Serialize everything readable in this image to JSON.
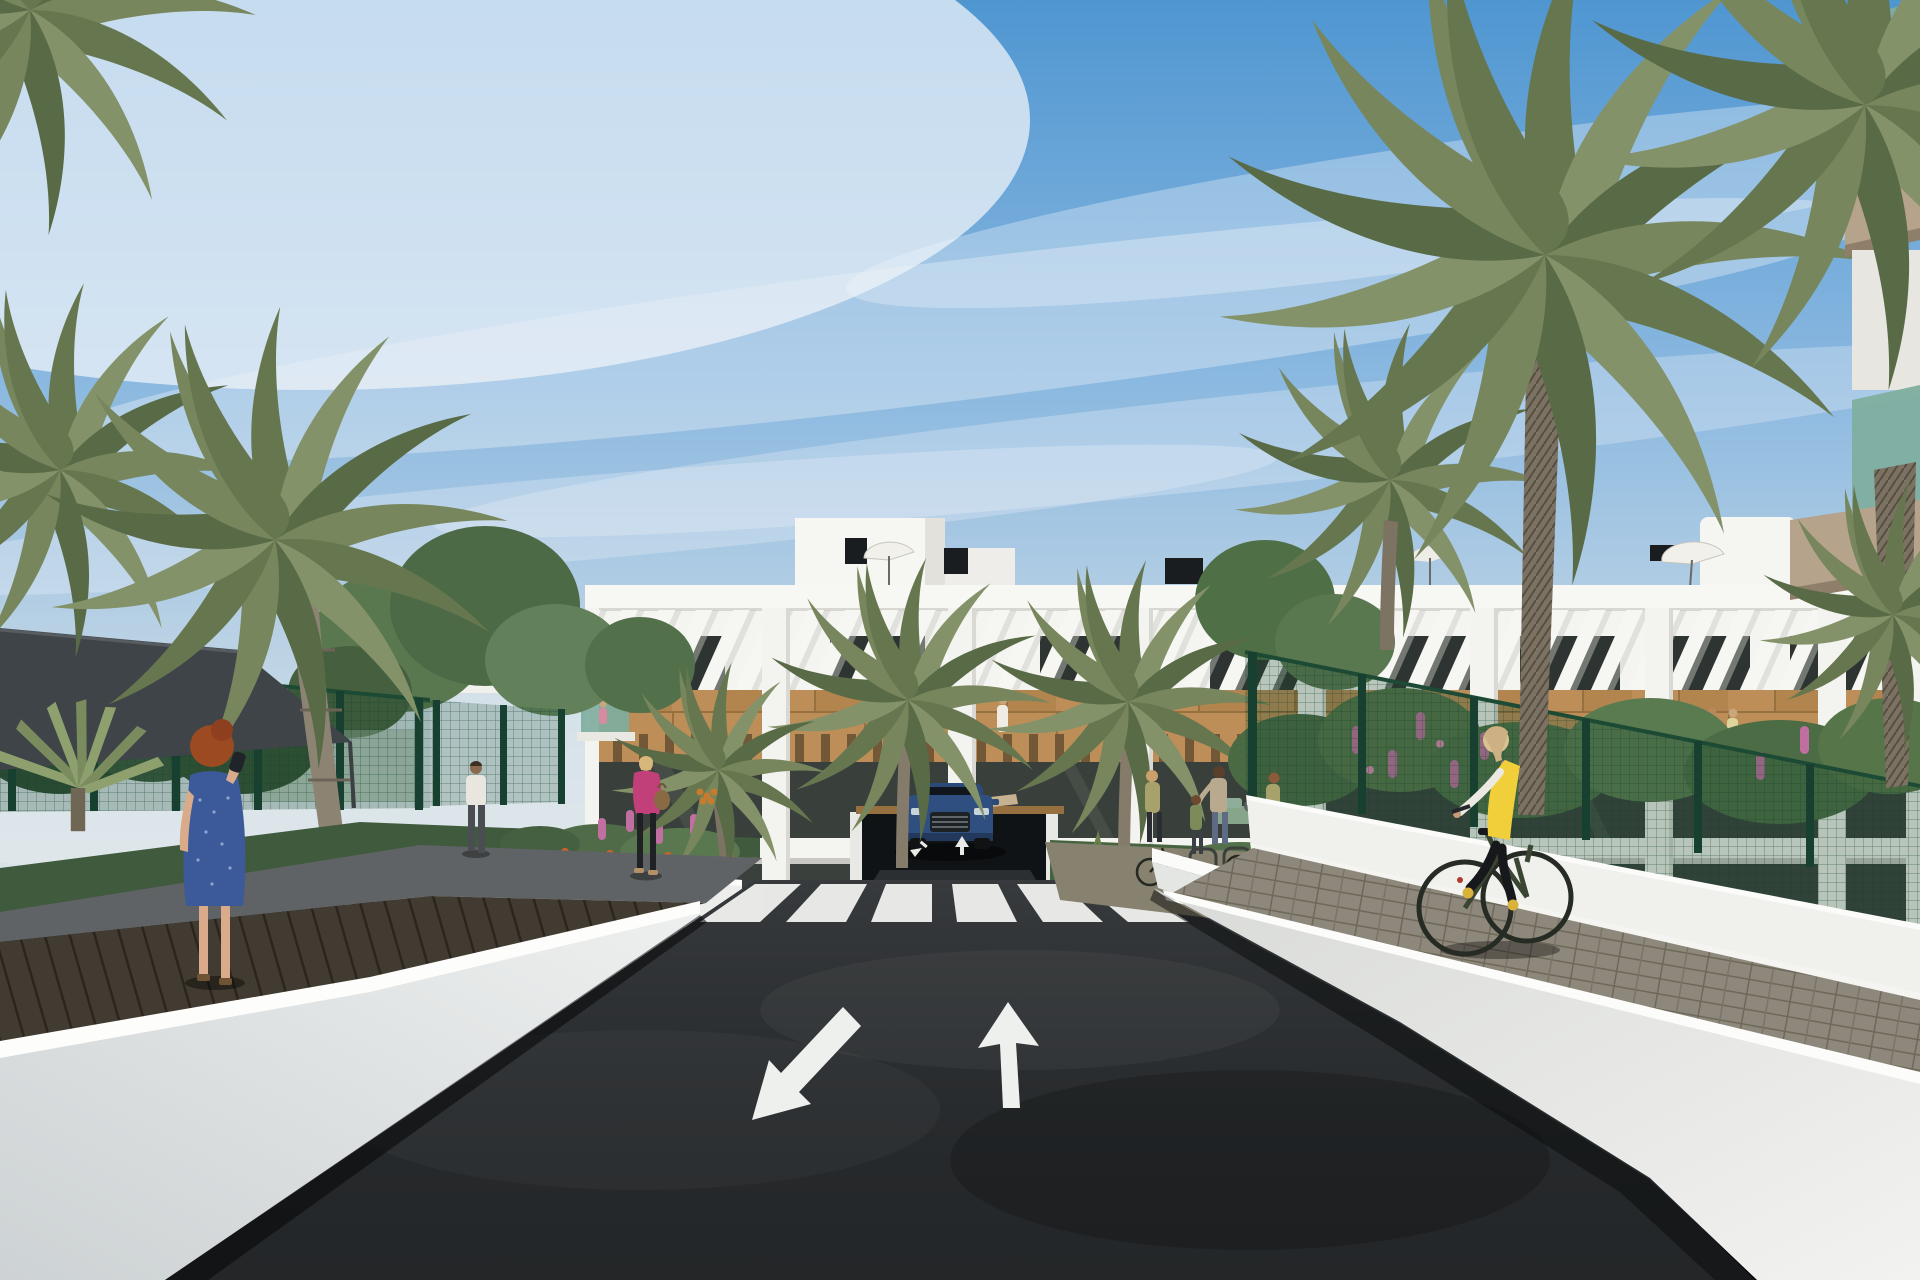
{
  "meta": {
    "title": "Residential complex street-view architectural rendering",
    "type": "3D exterior render, no UI text visible",
    "alt": "Computer-generated rendering of a modern white apartment complex with wood-clad balconies and rooftop umbrellas, palm trees, a dark asphalt entry road with a zebra crosswalk and two painted lane arrows, a blue SUV exiting an underground garage, pedestrians on side paths, a woman in a blue dress on a left walkway, and a cyclist in a yellow vest on a right paver sidewalk between white retaining walls and green mesh fences."
  },
  "scene": {
    "sky": "blue sky with wispy cirrus clouds, brighter haze upper-left and near horizon",
    "buildings": [
      "three-storey white apartment block with diagonal louvre screen on top floor",
      "horizontal wood cladding band between floors",
      "recessed balconies with wood pergolas and dark glazing",
      "rooftop stair towers, black chimney boxes, white parasols",
      "foreground building at right edge with green glass balconies and tan slabs"
    ],
    "road": {
      "surface": "dark asphalt entry drive",
      "markings": [
        "zebra crosswalk of six white bars",
        "down-left arrow",
        "straight-ahead up arrow",
        "two small arrows at garage ramp"
      ],
      "garage": "underground car park opening beneath central building"
    },
    "people": [
      "red-haired woman in blue patterned dress making a phone call on left plank walkway",
      "blonde woman in pink jacket with brown handbag walking on left path",
      "man in white t-shirt walking away on left path",
      "child behind left fence",
      "group at bike racks: woman with bicycle, mother with child, woman cycling away",
      "blonde cyclist in yellow vest and black leggings on right sidewalk",
      "small figures on balconies"
    ],
    "vehicles": [
      "dark blue SUV front-on at garage ramp",
      "dark green city bicycle"
    ],
    "vegetation": [
      "tall date palms left and right with textured trunks",
      "fan palm lower left",
      "small palms with orange fruit in front gardens",
      "leafy green trees behind left fence",
      "flower bushes with pink lupins and orange blooms",
      "ornamental grasses in planters"
    ],
    "structures": [
      "white perspective retaining walls with bright sunlit top edges",
      "dark charcoal shade sail over left play area",
      "dark green mesh fences with posts",
      "grey brick paver sidewalk right",
      "dark wood plank walkway left",
      "white planter walls flanking garage",
      "bicycle rack hoops",
      "small tan signboard on wall near ramp"
    ]
  },
  "palette": {
    "sky_top": "#4f96d1",
    "sky_horizon": "#dde4e8",
    "cloud": "#edf3f8",
    "building_white": "#f4f4f0",
    "parapet": "#f7f7f4",
    "wood": "#bd8e57",
    "wood_dark": "#97703f",
    "window_glass": "#2e3431",
    "terrace_glass": "#39403b",
    "balcony_glass_green": "#7fae9f",
    "slab_tan": "#b5a38c",
    "palm_a": "#77865c",
    "palm_b": "#66774f",
    "palm_c": "#84926a",
    "palm_d": "#596b46",
    "trunk": "#7b7263",
    "tree": "#4f6f46",
    "fence_green": "#1d4a34",
    "sail": "#3e4448",
    "asphalt": "#26292b",
    "path_grey": "#606365",
    "planks": "#423b31",
    "wall_bright": "#fdfdfb",
    "wall_light": "#eceeec",
    "wall_shade": "#cfd4d6",
    "paver": "#8e887c",
    "crosswalk": "#eff0ed",
    "car_blue": "#2f4f80",
    "vest_yellow": "#f0cf3a",
    "jacket_pink": "#c2407a",
    "dress_blue": "#3c5a9a",
    "skin": "#d9ab8b",
    "flower_pink": "#c06fa0",
    "flower_orange": "#d2622a"
  }
}
